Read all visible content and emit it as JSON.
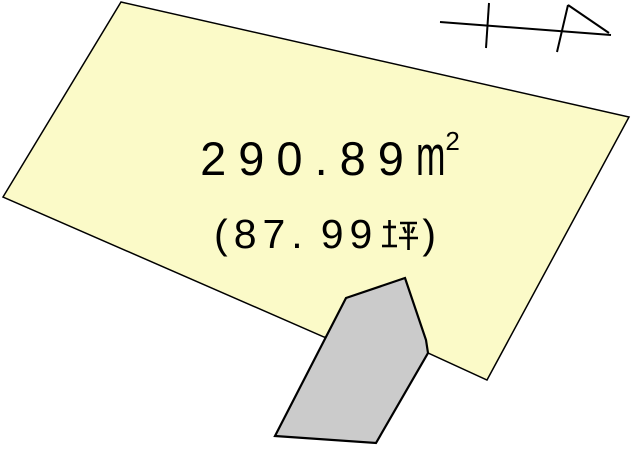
{
  "canvas": {
    "width": 632,
    "height": 451,
    "background": "#FFFFFF"
  },
  "text_color": "#000000",
  "plot": {
    "fill": "#FBFAC8",
    "stroke": "#000000",
    "points": "121,2 629,117 487,380 428,353 324,337 3,197",
    "area_sqm": {
      "int_part": "290",
      "dot": ".",
      "frac_part": "89",
      "unit_base": "m",
      "unit_exponent": "2",
      "unit_display": "㎡"
    },
    "area_tsubo": {
      "open_paren": "(",
      "int_part": "87",
      "dot": ".",
      "frac_part": "99",
      "unit": "坪",
      "close_paren": ")"
    }
  },
  "building": {
    "fill": "#CBCBCB",
    "stroke": "#000000",
    "points": "405,278 426,340 428,353 376,443 275,436 346,298"
  },
  "north_arrow": {
    "stroke": "#000000",
    "shaft": {
      "x1": 440,
      "y1": 22,
      "x2": 611,
      "y2": 35
    },
    "tick": {
      "x1": 489,
      "y1": 3,
      "x2": 486,
      "y2": 48
    },
    "head_left": {
      "x1": 568,
      "y1": 5,
      "x2": 557,
      "y2": 52
    },
    "head_top": {
      "x1": 568,
      "y1": 5,
      "x2": 609,
      "y2": 33
    }
  }
}
